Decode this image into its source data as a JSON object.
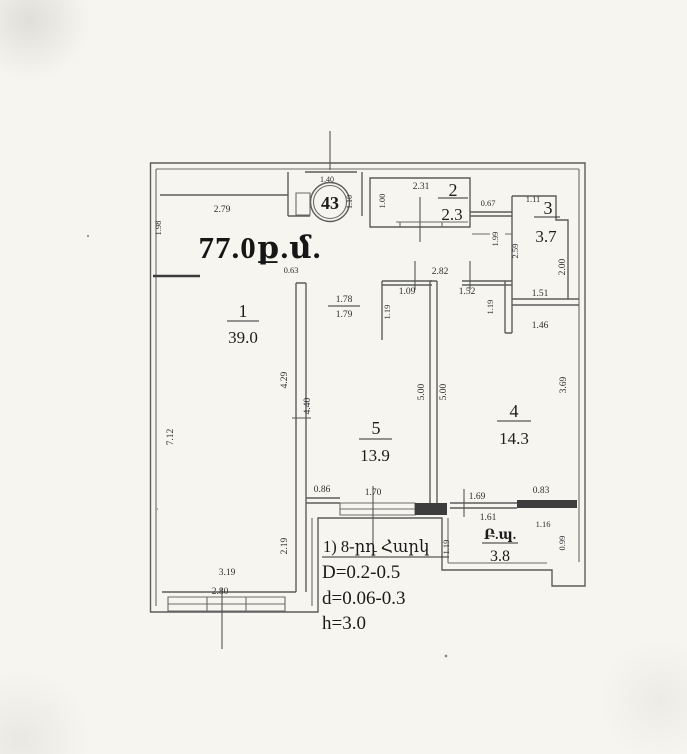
{
  "plan": {
    "apartment_number": "43",
    "total_area": "77.0ք.մ.",
    "rooms": [
      {
        "number": "1",
        "area": "39.0"
      },
      {
        "number": "2",
        "area": "2.3"
      },
      {
        "number": "3",
        "area": "3.7"
      },
      {
        "number": "4",
        "area": "14.3"
      },
      {
        "number": "5",
        "area": "13.9"
      }
    ],
    "balcony": {
      "label": "Բ.պ.",
      "area": "3.8"
    },
    "notes": [
      "1) 8-րդ Հարկ",
      "D=0.2-0.5",
      "d=0.06-0.3",
      "h=3.0"
    ],
    "dims": {
      "room1_top": "2.79",
      "left_upper": "1.98",
      "left_wall": "7.12",
      "entry_width": "1.40",
      "entry_side": "1.10",
      "room2_top": "2.31",
      "room2_left": "1.00",
      "passage_right": "0.67",
      "room3_top": "1.11",
      "room3_left_outer": "1.99",
      "room3_left": "2.59",
      "room3_right": "2.00",
      "room3_bottom": "1.51",
      "room1_door": "0.63",
      "hall_width": "2.82",
      "door_width_a": "1.78",
      "door_width_b": "1.79",
      "hall_seg_left": "1.09",
      "hall_seg_right": "1.52",
      "jamb_left": "1.19",
      "jamb_right": "1.19",
      "room4_top": "1.46",
      "room1_right": "4.29",
      "room5_left": "4.40",
      "room5_height": "5.00",
      "room4_height": "5.00",
      "room4_right": "3.69",
      "room5_bottom_left": "0.86",
      "room5_window": "1.70",
      "balcony_door_top": "1.69",
      "balcony_door_bottom": "1.61",
      "room4_bottom_right": "0.83",
      "balcony_top_right": "1.16",
      "balcony_right": "0.99",
      "balcony_left": "1.19",
      "room1_bottom_right": "2.19",
      "room1_bottom": "3.19",
      "room1_window": "2.80"
    }
  }
}
